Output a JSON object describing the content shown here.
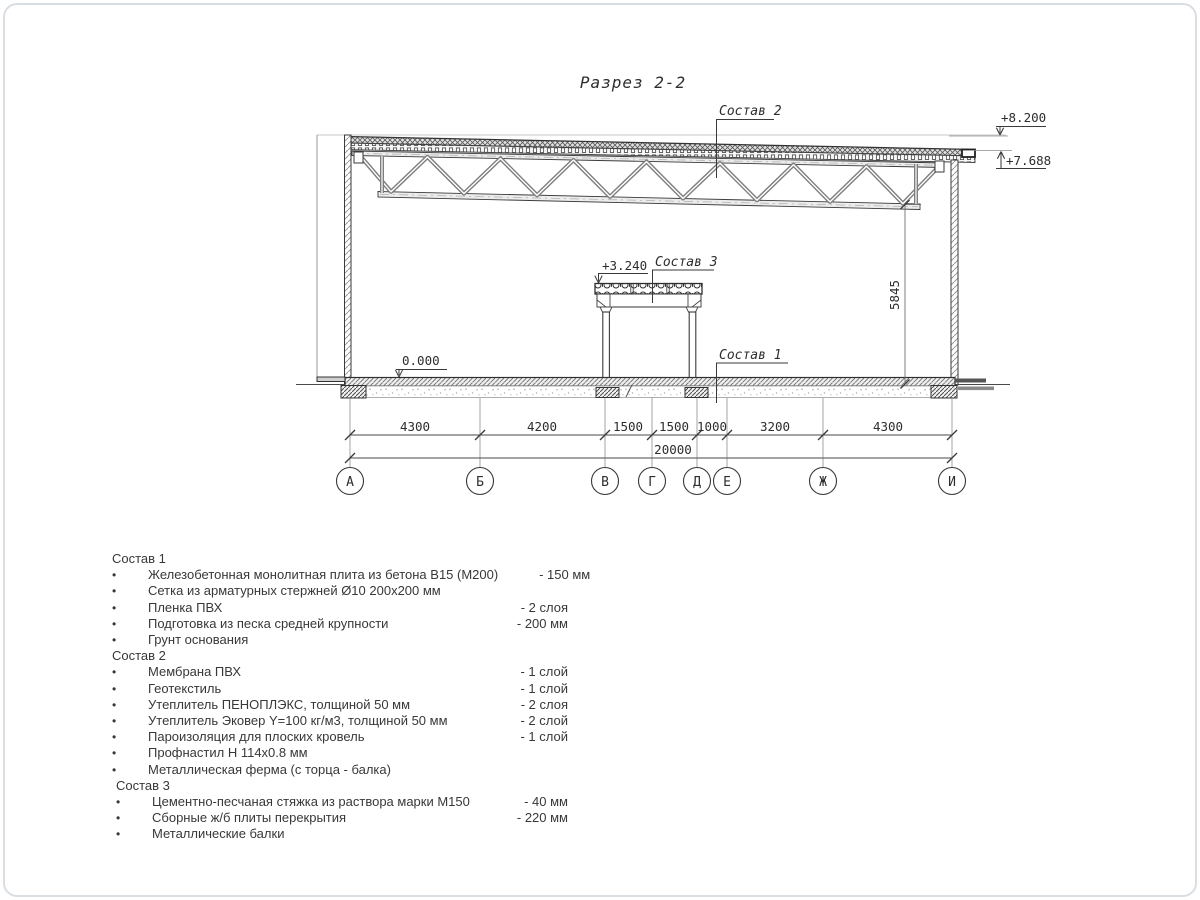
{
  "page": {
    "title": "Разрез 2-2"
  },
  "drawing": {
    "callouts": {
      "c1": "Состав 1",
      "c2": "Состав 2",
      "c3": "Состав 3"
    },
    "elevations": {
      "top": "+8.200",
      "edge": "+7.688",
      "mezz": "+3.240",
      "floor": "0.000"
    },
    "height_dim": "5845",
    "dims": [
      "4300",
      "4200",
      "1500",
      "1500",
      "1000",
      "3200",
      "4300"
    ],
    "total": "20000",
    "axes": [
      "А",
      "Б",
      "В",
      "Г",
      "Д",
      "Е",
      "Ж",
      "И"
    ]
  },
  "legend": {
    "bullet": "•",
    "sections": [
      {
        "title": "Состав 1",
        "items": [
          {
            "text": "Железобетонная монолитная плита из бетона В15 (М200)",
            "value": "-  150 мм"
          },
          {
            "text": "Сетка из арматурных стержней Ø10 200x200 мм",
            "value": ""
          },
          {
            "text": "Пленка ПВХ",
            "value": "-  2 слоя"
          },
          {
            "text": "Подготовка из песка средней крупности",
            "value": "- 200 мм"
          },
          {
            "text": "Грунт основания",
            "value": ""
          }
        ]
      },
      {
        "title": "Состав 2",
        "items": [
          {
            "text": "Мембрана ПВХ",
            "value": "- 1 слой"
          },
          {
            "text": "Геотекстиль",
            "value": "- 1 слой"
          },
          {
            "text": "Утеплитель ПЕНОПЛЭКС, толщиной 50 мм",
            "value": "- 2 слоя"
          },
          {
            "text": "Утеплитель Эковер Y=100 кг/м3, толщиной 50 мм",
            "value": "- 2 слой"
          },
          {
            "text": "Пароизоляция для плоских кровель",
            "value": "- 1 слой"
          },
          {
            "text": "Профнастил Н 114x0.8 мм",
            "value": ""
          },
          {
            "text": "Металлическая ферма (с торца - балка)",
            "value": ""
          }
        ]
      },
      {
        "title": "Состав 3",
        "items": [
          {
            "text": "Цементно-песчаная стяжка из раствора марки М150",
            "value": "-  40 мм"
          },
          {
            "text": "Сборные ж/б плиты перекрытия",
            "value": "- 220 мм"
          },
          {
            "text": "Металлические балки",
            "value": ""
          }
        ]
      }
    ]
  }
}
